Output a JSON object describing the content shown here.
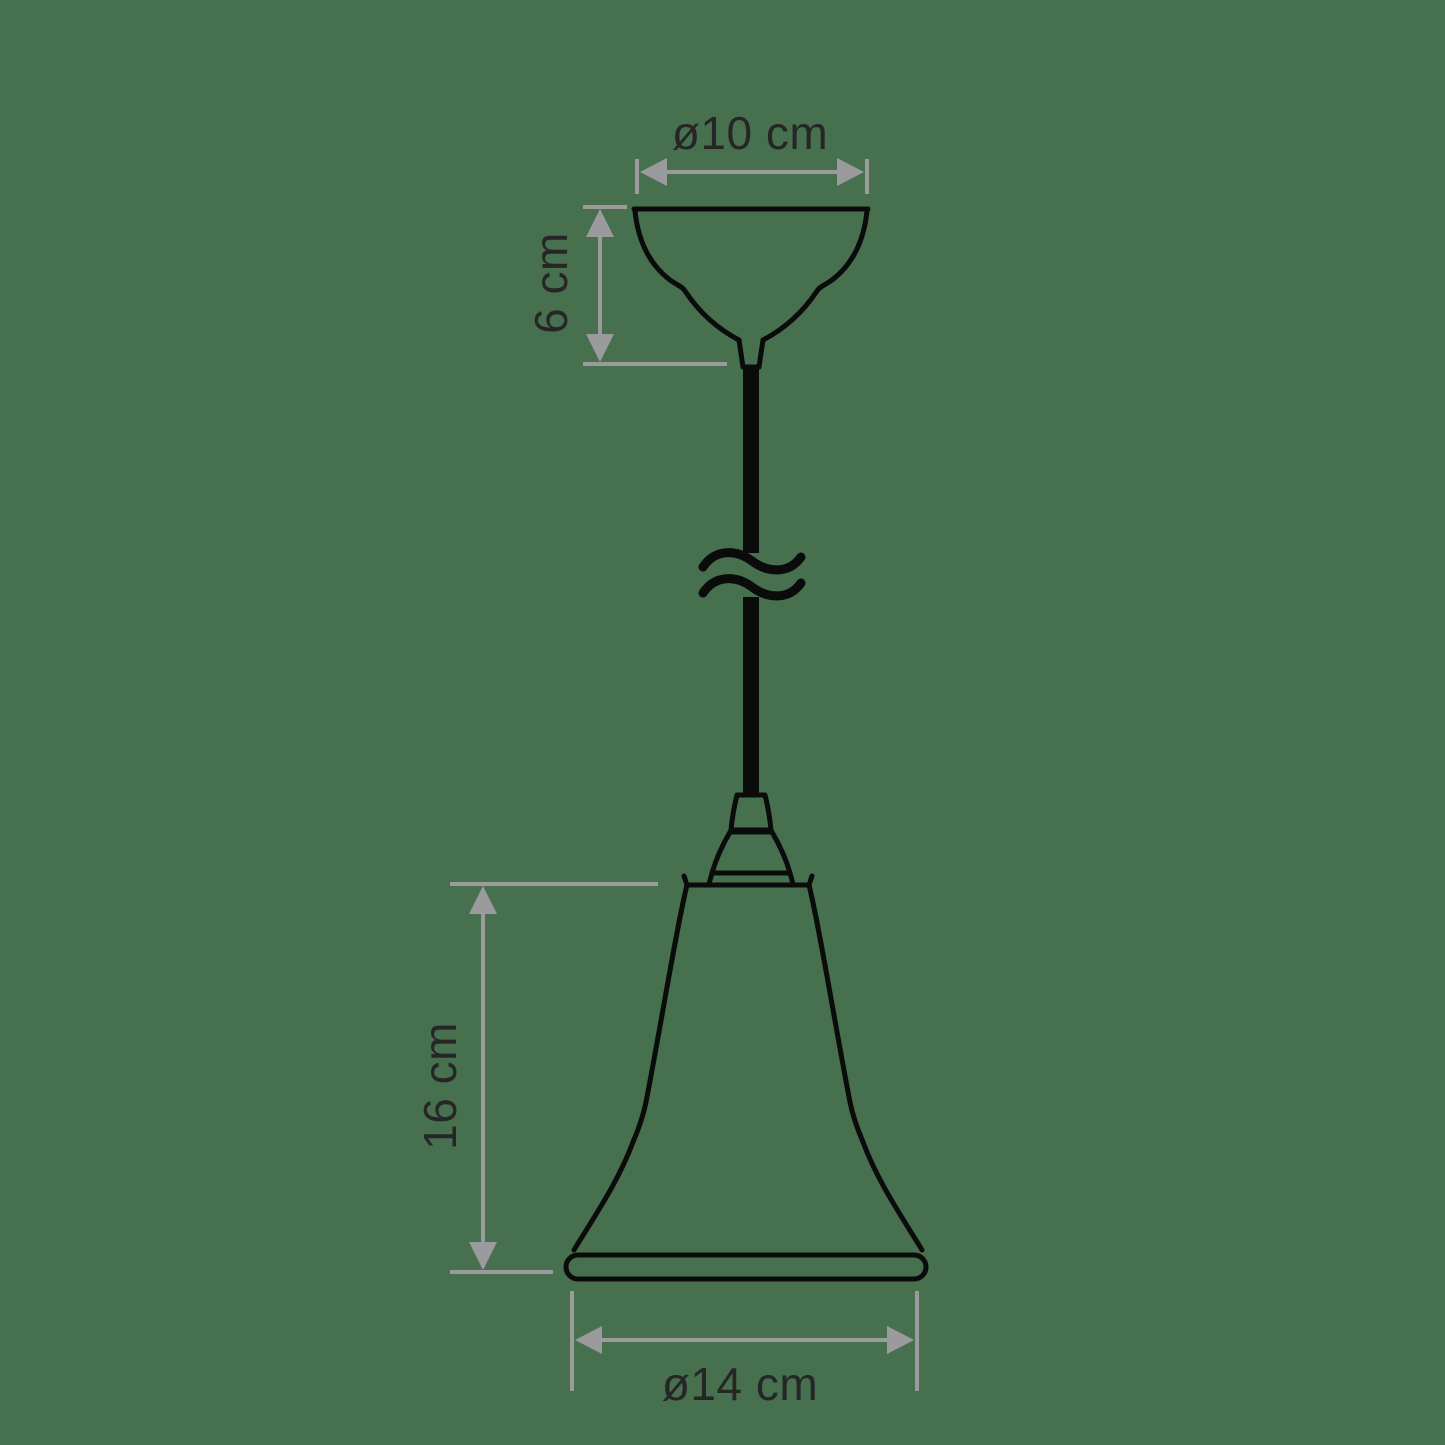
{
  "colors": {
    "background": "#47704F",
    "outline": "#0b0b0b",
    "dimension": "#9B9B9D",
    "label": "#262626"
  },
  "labels": {
    "canopy_diameter": "ø10 cm",
    "canopy_height": "6 cm",
    "shade_height": "16 cm",
    "shade_diameter": "ø14 cm"
  }
}
